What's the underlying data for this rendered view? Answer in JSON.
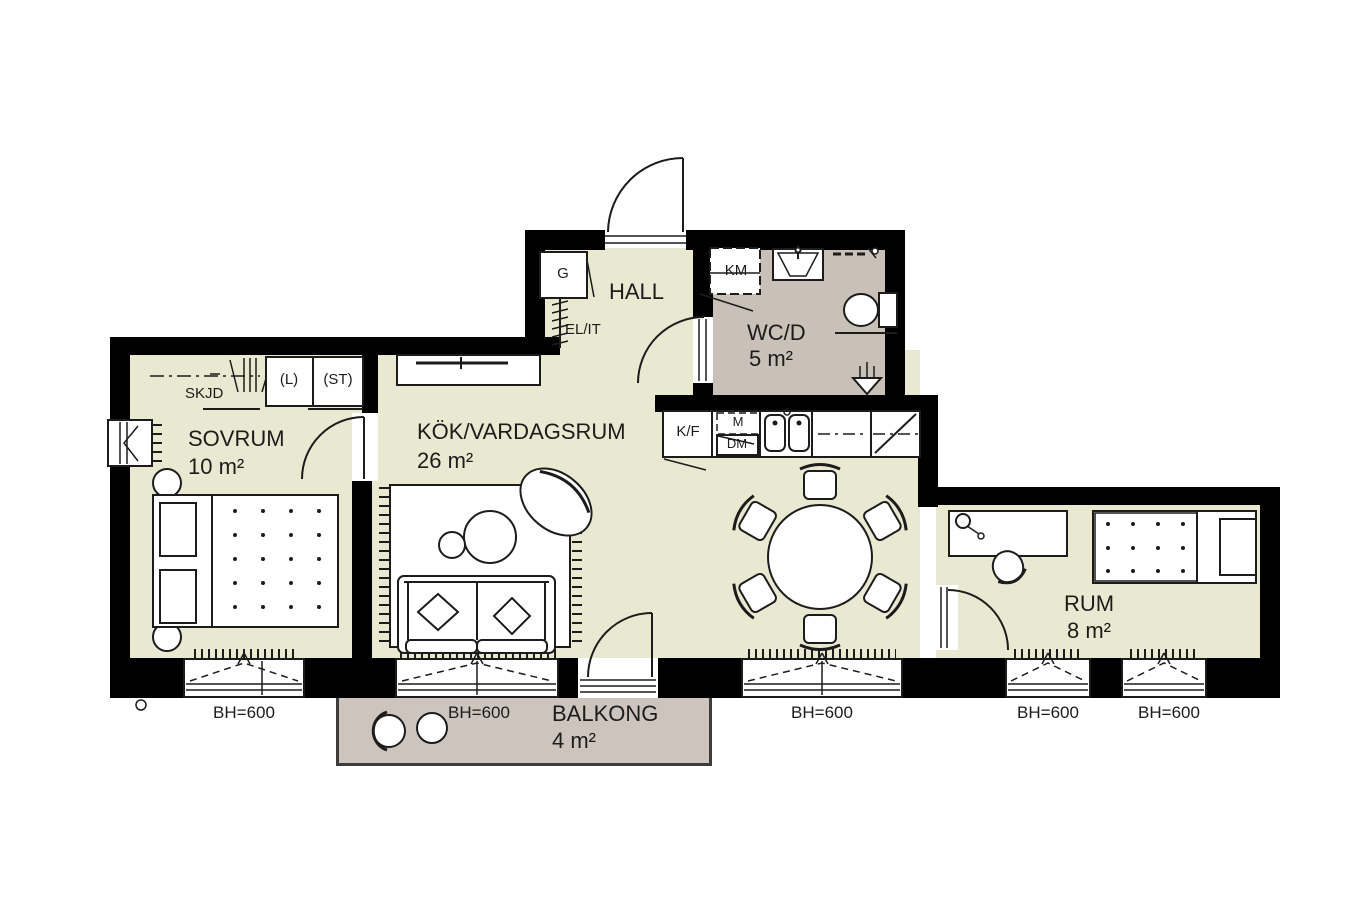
{
  "plan": {
    "rooms": {
      "sovrum": {
        "name": "SOVRUM",
        "area": "10 m²"
      },
      "kok": {
        "name": "KÖK/VARDAGSRUM",
        "area": "26 m²"
      },
      "hall": {
        "name": "HALL"
      },
      "wcd": {
        "name": "WC/D",
        "area": "5 m²"
      },
      "rum": {
        "name": "RUM",
        "area": "8 m²"
      },
      "balkong": {
        "name": "BALKONG",
        "area": "4 m²"
      }
    },
    "fixtures": {
      "skjd": "SKJD",
      "l": "(L)",
      "st": "(ST)",
      "g": "G",
      "elit": "EL/IT",
      "km": "KM",
      "kf": "K/F",
      "m": "M",
      "dm": "DM"
    },
    "bh_labels": [
      "BH=600",
      "BH=600",
      "BH=600",
      "BH=600",
      "BH=600"
    ],
    "colors": {
      "wall": "#000000",
      "line": "#1c1c1c",
      "floor": "#e9e9d2",
      "wet_floor": "#c9c0b8",
      "balcony_floor": "#ccc4bd"
    }
  }
}
